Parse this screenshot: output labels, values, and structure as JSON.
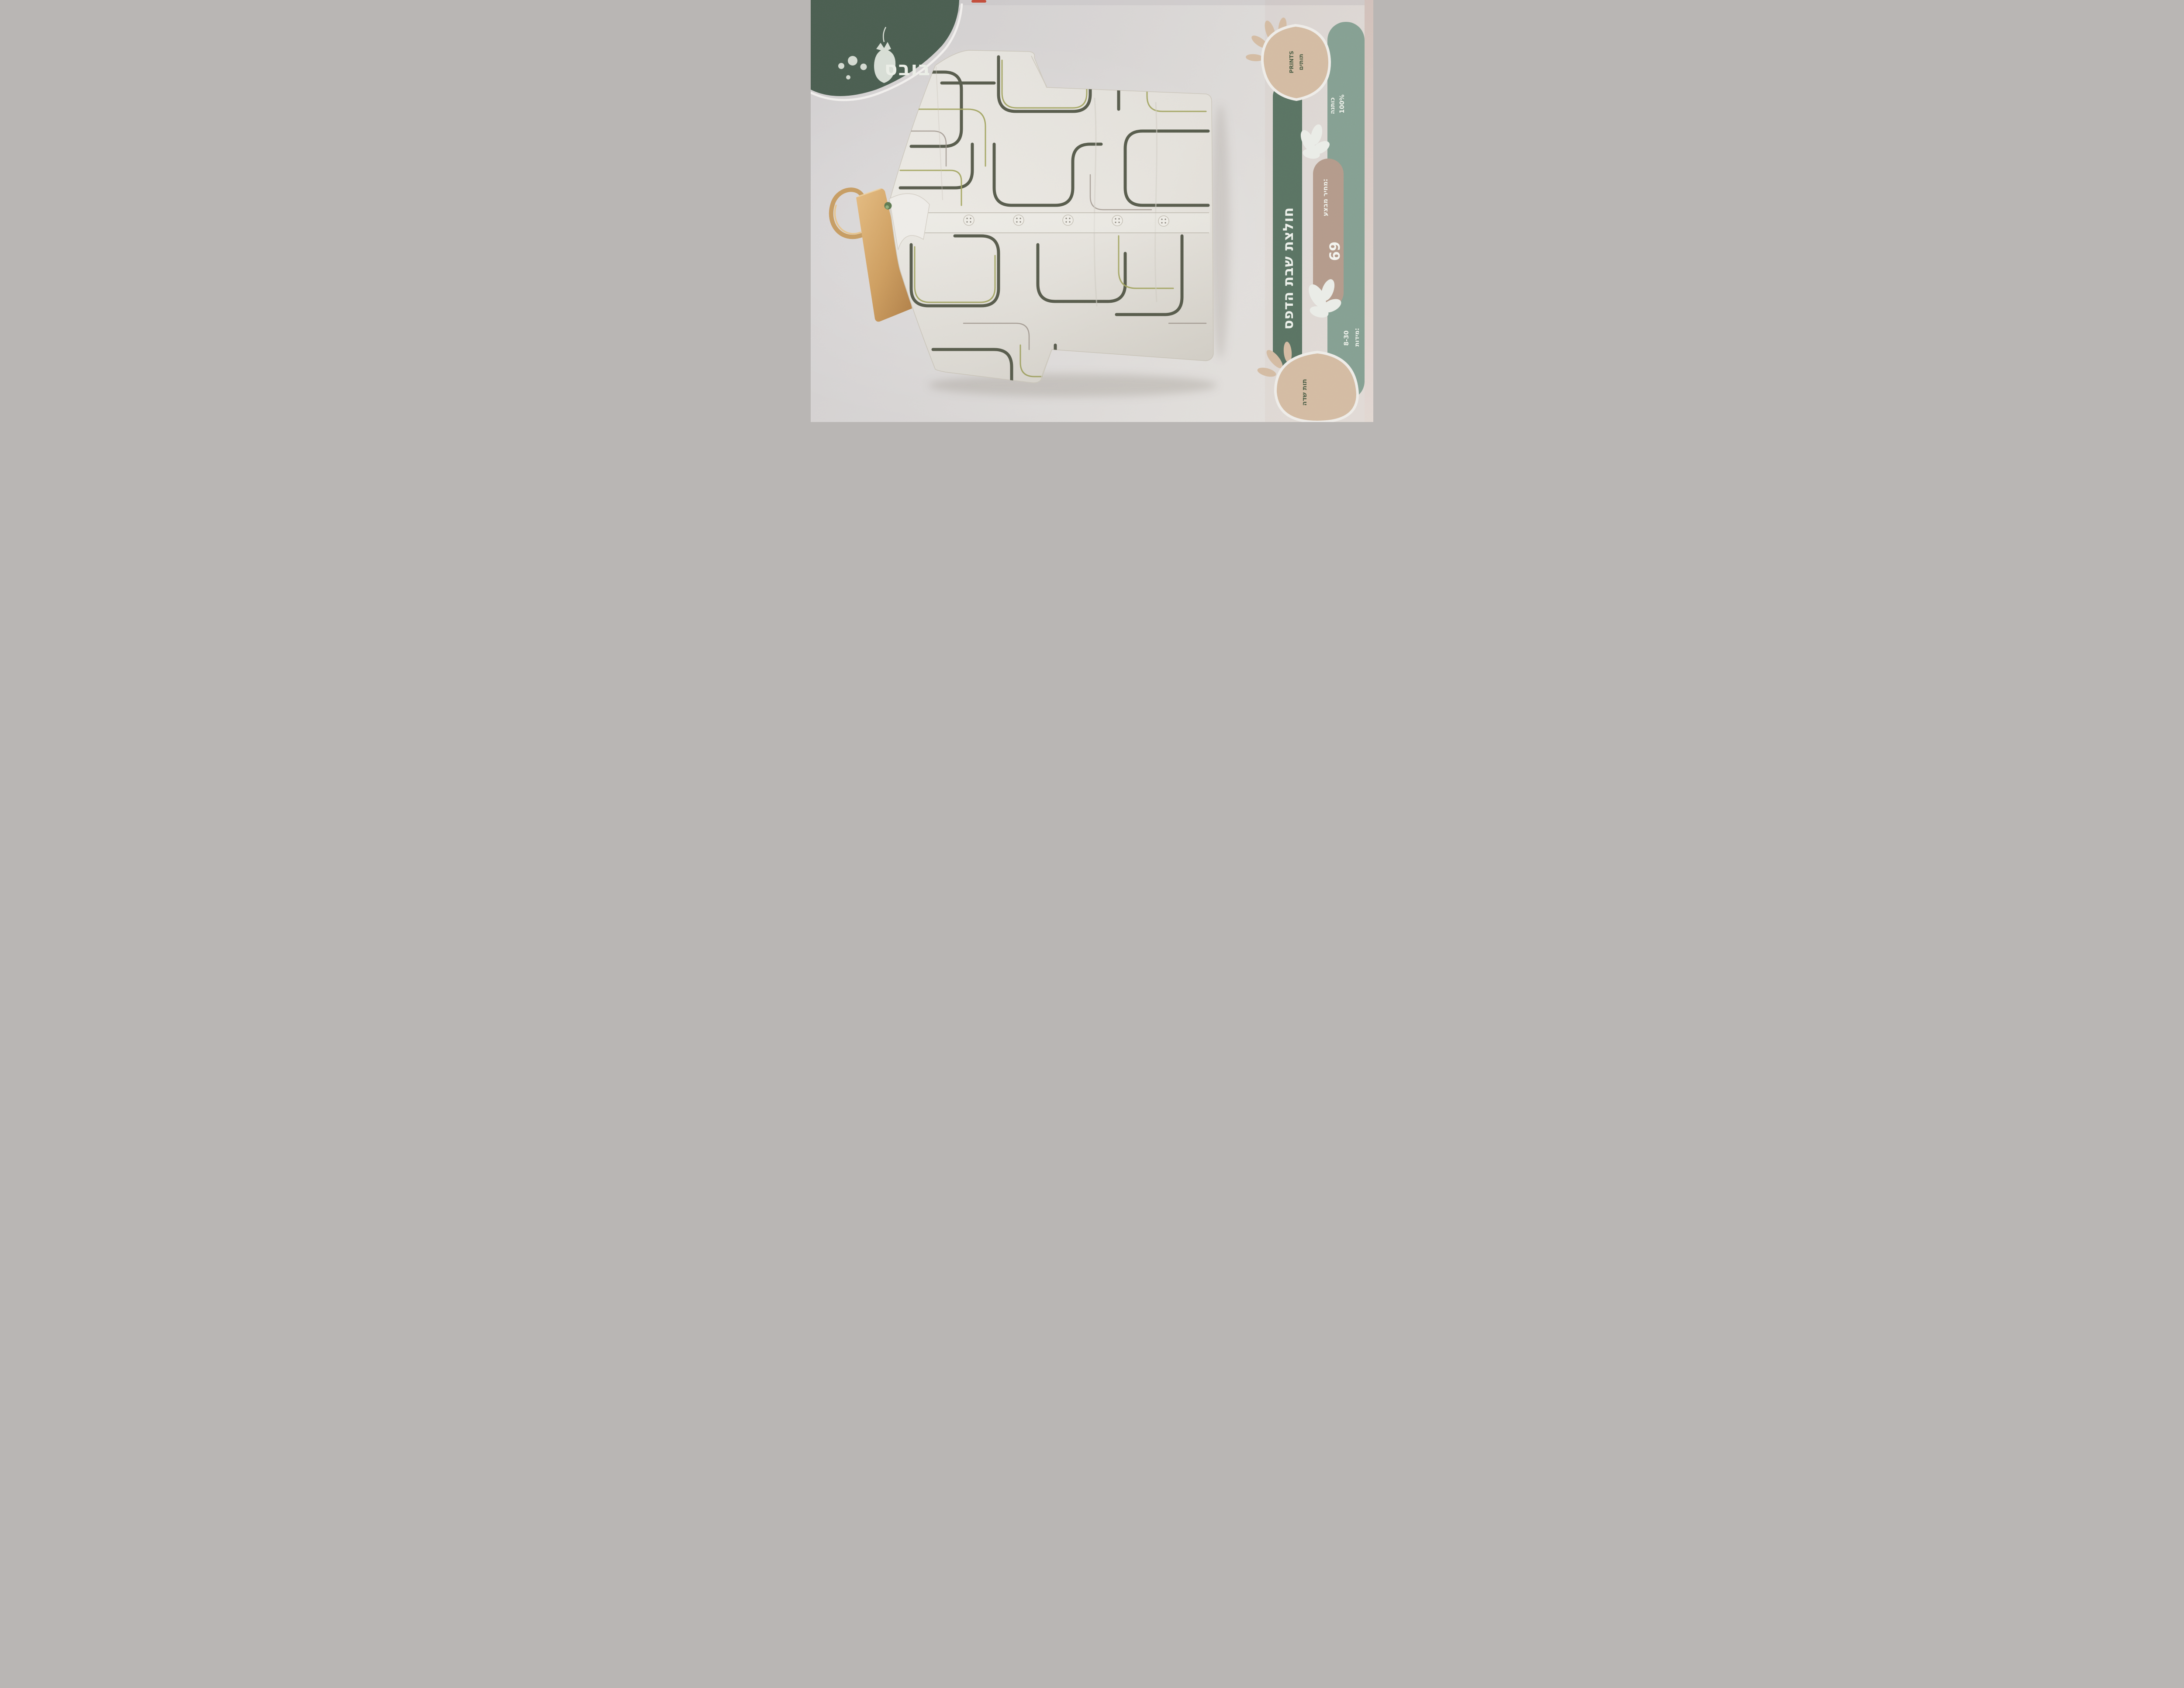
{
  "photo_subject": "printed catalog page with patterned button-up shirt on wooden hanger",
  "logo": {
    "brand": "בובס",
    "icon": "strawberry-icon",
    "dots": 4
  },
  "title_band": {
    "text": "חולצת שבת הדפס"
  },
  "info_column": {
    "top_strawberry": {
      "line1": "תותים",
      "line2": "PRINTS"
    },
    "teal_band": {
      "upper_line1": "100%",
      "upper_line2": "כותנה",
      "sizes_line1": "מידות:",
      "sizes_line2": "8-30"
    },
    "pink_band": {
      "label": "מחיר מבצע:",
      "price": "69"
    },
    "bottom_strawberry": {
      "text": "תות שדה"
    }
  },
  "shirt": {
    "buttons": 6,
    "pattern": "abstract rounded meander lines"
  },
  "colors": {
    "badge_green": "#4a5e50",
    "title_band_green": "#5a7463",
    "teal_band": "#86a193",
    "pink_band": "#b59c8c",
    "strawberry_tan": "#d5bda4",
    "pattern_dark": "#484d3c",
    "pattern_olive": "#a7a963",
    "pattern_grey": "#9d948b",
    "hanger_wood": "#c89e63",
    "fabric": "#edebe5"
  }
}
